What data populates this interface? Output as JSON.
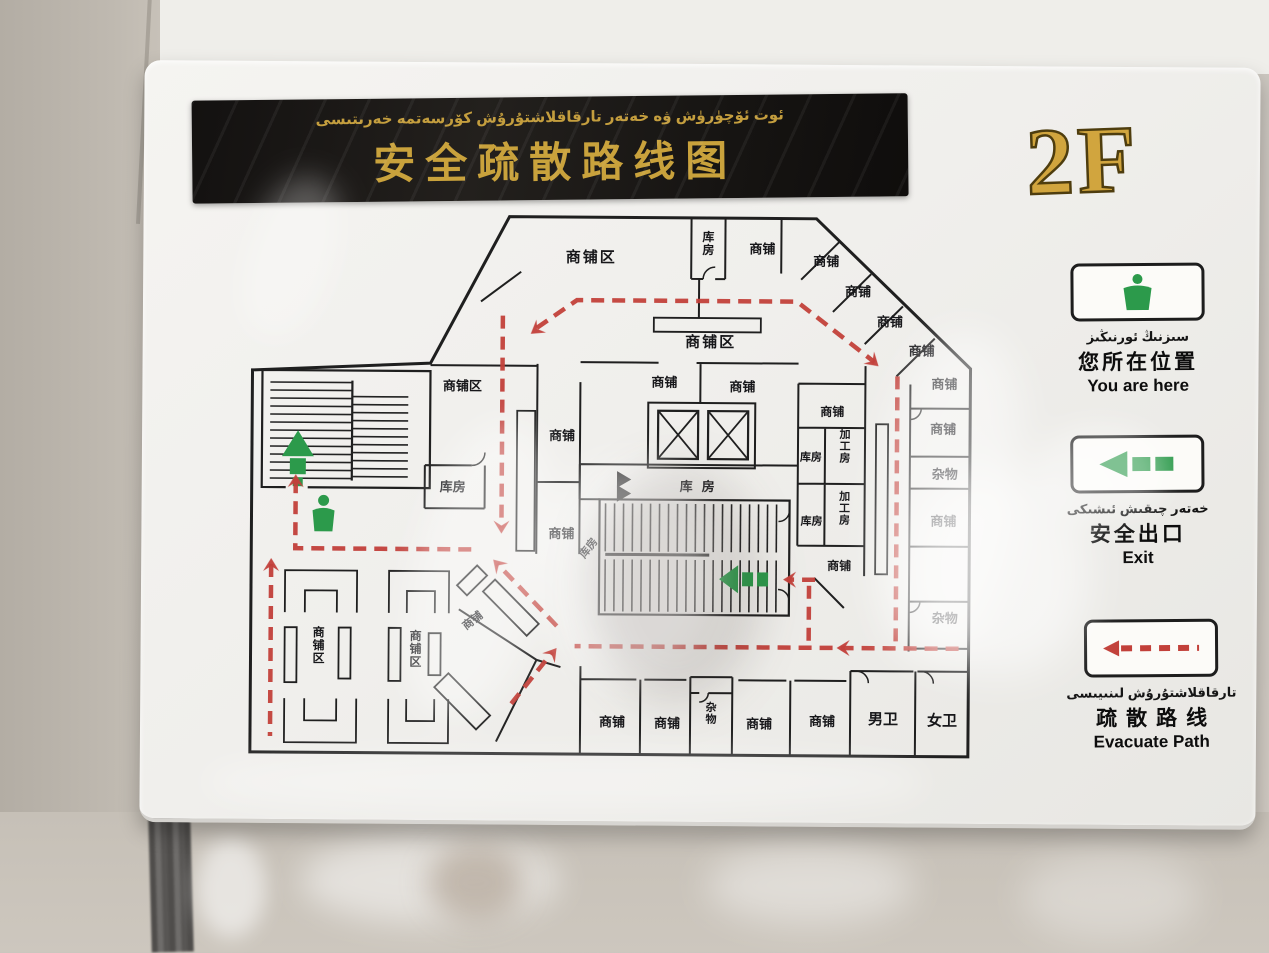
{
  "sign": {
    "floor_label": "2F",
    "banner": {
      "title_uyghur": "ئوت ئۆچۈرۈش ۋە خەتەر تارقاقلاشتۇرۇش كۆرسەتمە خەرىتىسى",
      "title_chinese": "安全疏散路线图"
    },
    "legend": [
      {
        "id": "you-are-here",
        "uyghur": "سىزنىڭ ئورنىڭىز",
        "chinese": "您所在位置",
        "english": "You are here",
        "icon": "person-icon"
      },
      {
        "id": "exit",
        "uyghur": "خەتەر چىقىش ئىشىكى",
        "chinese": "安全出口",
        "english": "Exit",
        "icon": "exit-arrow-icon"
      },
      {
        "id": "evacuate-path",
        "uyghur": "تارقاقلاشتۇرۇش لىنىيىسى",
        "chinese": "疏散路线",
        "english": "Evacuate Path",
        "icon": "dashed-arrow-icon"
      }
    ],
    "colors": {
      "gold": "#c9a23c",
      "green": "#2c9a4b",
      "path_red": "#c2403a",
      "line_ink": "#1f1f1f"
    },
    "map": {
      "rooms": [
        {
          "label": "商铺区",
          "x": 350,
          "y": 48,
          "size": 15,
          "ls": 2
        },
        {
          "label": "库房",
          "x": 467,
          "y": 26,
          "vertical": true,
          "size": 12
        },
        {
          "label": "商铺",
          "x": 521,
          "y": 38
        },
        {
          "label": "商铺",
          "x": 585,
          "y": 50
        },
        {
          "label": "商铺",
          "x": 617,
          "y": 80
        },
        {
          "label": "商铺",
          "x": 649,
          "y": 110
        },
        {
          "label": "商铺",
          "x": 681,
          "y": 139
        },
        {
          "label": "商铺",
          "x": 704,
          "y": 172
        },
        {
          "label": "商铺",
          "x": 703,
          "y": 217
        },
        {
          "label": "杂物",
          "x": 705,
          "y": 262
        },
        {
          "label": "商铺",
          "x": 704,
          "y": 309
        },
        {
          "label": "杂物",
          "x": 706,
          "y": 406
        },
        {
          "label": "商铺区",
          "x": 470,
          "y": 132,
          "size": 15,
          "ls": 2
        },
        {
          "label": "商铺",
          "x": 424,
          "y": 172
        },
        {
          "label": "商铺",
          "x": 502,
          "y": 176
        },
        {
          "label": "库房",
          "x": 462,
          "y": 276,
          "ls": 9
        },
        {
          "label": "商铺",
          "x": 322,
          "y": 226
        },
        {
          "label": "商铺",
          "x": 322,
          "y": 324
        },
        {
          "label": "库房",
          "x": 213,
          "y": 278
        },
        {
          "label": "商铺区",
          "x": 222,
          "y": 177,
          "size": 13
        },
        {
          "label": "库房",
          "x": 352,
          "y": 336,
          "rotate": -52,
          "size": 11
        },
        {
          "label": "库房",
          "x": 571,
          "y": 245,
          "size": 11
        },
        {
          "label": "库房",
          "x": 572,
          "y": 309,
          "size": 11
        },
        {
          "label": "加工房",
          "x": 605,
          "y": 222,
          "vertical": true,
          "size": 11
        },
        {
          "label": "加工房",
          "x": 605,
          "y": 284,
          "vertical": true,
          "size": 11
        },
        {
          "label": "商铺",
          "x": 592,
          "y": 200,
          "size": 12
        },
        {
          "label": "商铺",
          "x": 600,
          "y": 354,
          "size": 12
        },
        {
          "label": "商铺",
          "x": 374,
          "y": 512
        },
        {
          "label": "商铺",
          "x": 429,
          "y": 513
        },
        {
          "label": "杂物",
          "x": 473,
          "y": 496,
          "vertical": true,
          "size": 11
        },
        {
          "label": "商铺",
          "x": 521,
          "y": 513
        },
        {
          "label": "商铺",
          "x": 584,
          "y": 510
        },
        {
          "label": "男卫",
          "x": 645,
          "y": 508,
          "size": 15
        },
        {
          "label": "女卫",
          "x": 704,
          "y": 509,
          "size": 15
        },
        {
          "label": "商铺区",
          "x": 80,
          "y": 424,
          "vertical": true,
          "size": 12
        },
        {
          "label": "商铺区",
          "x": 177,
          "y": 427,
          "vertical": true,
          "size": 12
        },
        {
          "label": "商铺",
          "x": 236,
          "y": 410,
          "rotate": -38,
          "size": 11
        }
      ]
    }
  }
}
